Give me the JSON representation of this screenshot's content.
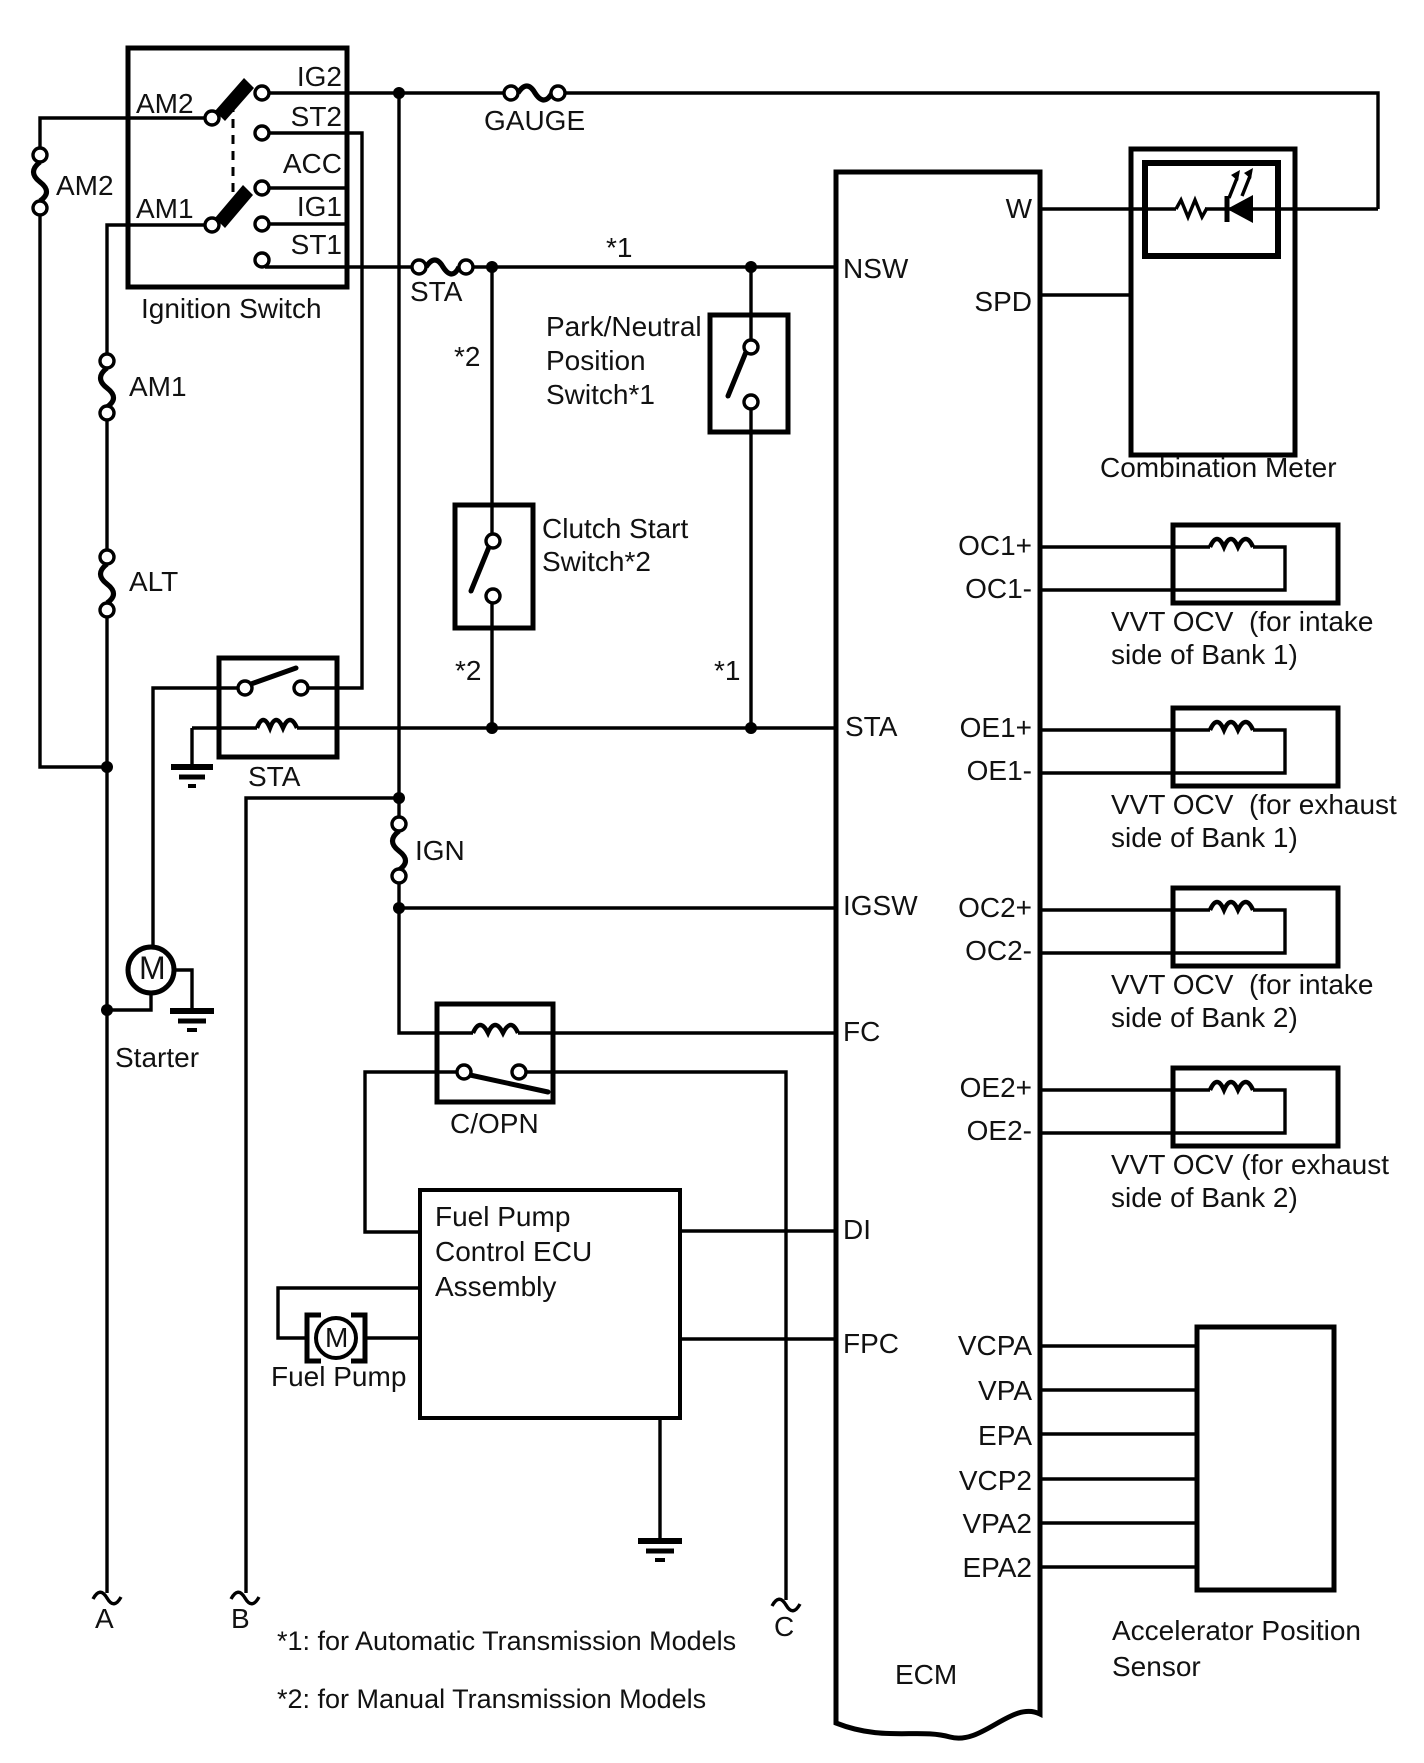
{
  "ignition_switch": {
    "label": "Ignition Switch",
    "am2": "AM2",
    "am1": "AM1",
    "ig2": "IG2",
    "st2": "ST2",
    "acc": "ACC",
    "ig1": "IG1",
    "st1": "ST1"
  },
  "fuses": {
    "am2": "AM2",
    "am1": "AM1",
    "alt": "ALT",
    "gauge": "GAUGE",
    "sta": "STA",
    "ign": "IGN"
  },
  "relays": {
    "sta": "STA",
    "copn": "C/OPN"
  },
  "switches": {
    "pnp": [
      "Park/Neutral",
      "Position",
      "Switch*1"
    ],
    "clutch": [
      "Clutch Start",
      "Switch*2"
    ]
  },
  "starter": {
    "label": "Starter",
    "motor": "M"
  },
  "fuel_pump": {
    "label": "Fuel Pump",
    "motor": "M"
  },
  "fp_ecu": [
    "Fuel Pump",
    "Control ECU",
    "Assembly"
  ],
  "ecm": {
    "label": "ECM",
    "left_terminals": [
      "NSW",
      "STA",
      "IGSW",
      "FC",
      "DI",
      "FPC"
    ],
    "right_terminals": [
      "W",
      "SPD",
      "OC1+",
      "OC1-",
      "OE1+",
      "OE1-",
      "OC2+",
      "OC2-",
      "OE2+",
      "OE2-",
      "VCPA",
      "VPA",
      "EPA",
      "VCP2",
      "VPA2",
      "EPA2"
    ]
  },
  "combination_meter": {
    "label": "Combination Meter"
  },
  "vvt_ocv": [
    [
      "VVT OCV  (for intake",
      "side of Bank 1)"
    ],
    [
      "VVT OCV  (for exhaust",
      "side of Bank 1)"
    ],
    [
      "VVT OCV  (for intake",
      "side of Bank 2)"
    ],
    [
      "VVT OCV (for exhaust",
      "side of Bank 2)"
    ]
  ],
  "accel_sensor": [
    "Accelerator Position",
    "Sensor"
  ],
  "connectors": {
    "a": "A",
    "b": "B",
    "c": "C"
  },
  "annotations": {
    "star1": "*1",
    "star2": "*2",
    "note1": "*1: for Automatic Transmission Models",
    "note2": "*2: for Manual Transmission Models"
  },
  "colors": {
    "line": "#000000",
    "background": "#ffffff"
  }
}
